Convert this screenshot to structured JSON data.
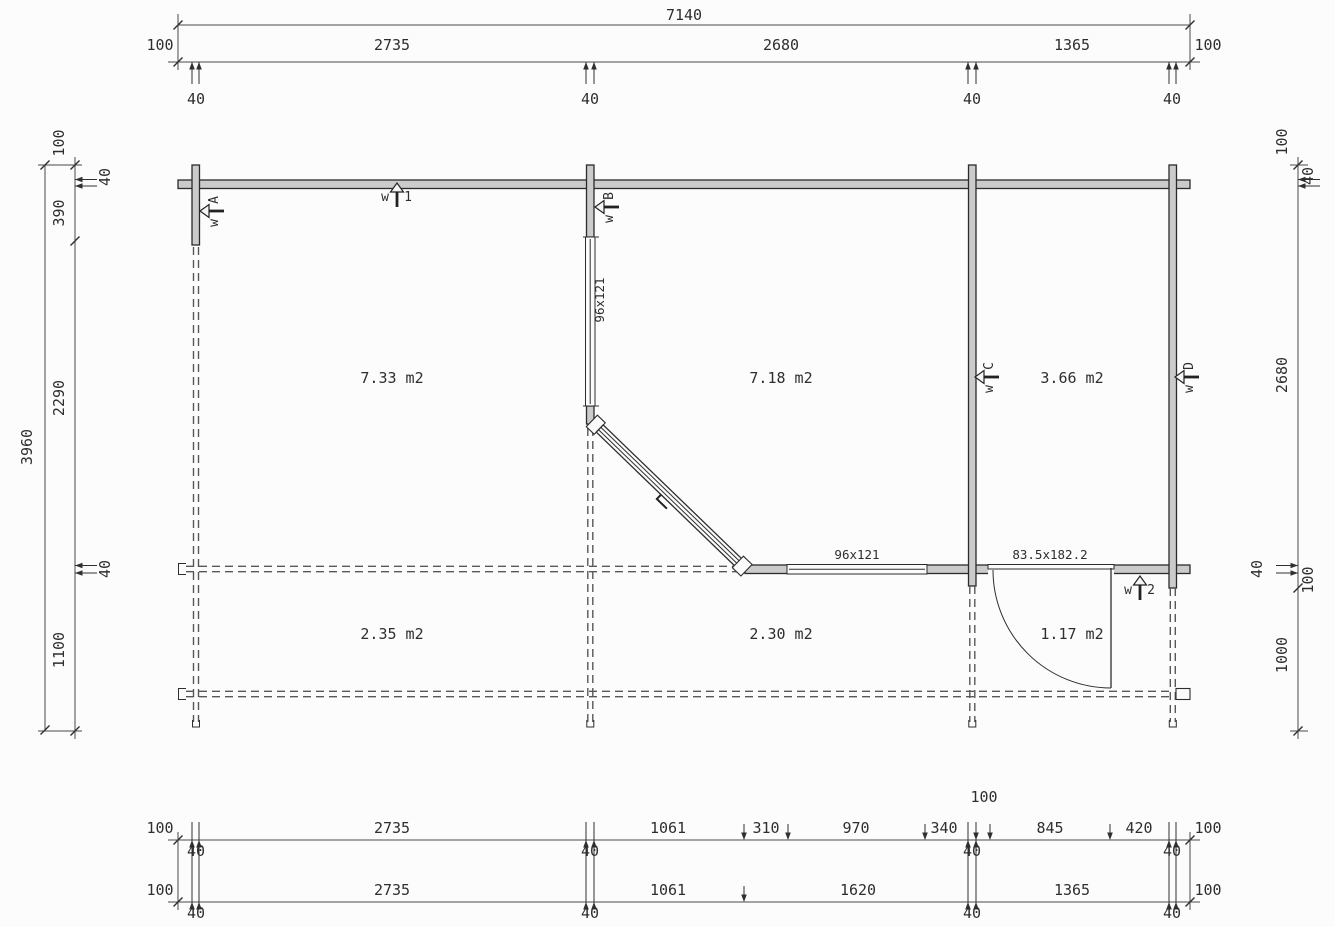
{
  "drawing_title": "log cabin floor plan",
  "dims": {
    "wall40": "40",
    "top": {
      "overall": "7140",
      "c0": "100",
      "c1": "2735",
      "c2": "2680",
      "c3": "1365",
      "c4": "100"
    },
    "left": {
      "overall": "3960",
      "c0": "100",
      "c1": "40",
      "c2": "390",
      "c3": "2290",
      "c4": "40",
      "c5": "1100"
    },
    "right": {
      "c0": "100",
      "c1": "40",
      "c2": "2680",
      "c3": "40",
      "c4": "100",
      "c5": "1000"
    },
    "b1": {
      "c0": "100",
      "c1": "2735",
      "c2": "1061",
      "c3": "310",
      "c4": "970",
      "c5": "340",
      "c6": "845",
      "c7": "420",
      "c8": "100",
      "above": "100"
    },
    "b2": {
      "c0": "100",
      "c1": "2735",
      "c2": "1061",
      "c3": "1620",
      "c4": "1365",
      "c5": "100"
    }
  },
  "rooms": {
    "r1": "7.33 m2",
    "r2": "7.18 m2",
    "r3": "3.66 m2",
    "r4": "2.35 m2",
    "r5": "2.30 m2",
    "r6": "1.17 m2"
  },
  "openings": {
    "window_b": "96x121",
    "window_front": "96x121",
    "door_front": "83.5x182.2"
  },
  "markers": {
    "w1": {
      "prefix": "w",
      "id": "1"
    },
    "w2": {
      "prefix": "w",
      "id": "2"
    },
    "wa": {
      "prefix": "w",
      "id": "A"
    },
    "wb": {
      "prefix": "w",
      "id": "B"
    },
    "wc": {
      "prefix": "w",
      "id": "C"
    },
    "wd": {
      "prefix": "w",
      "id": "D"
    }
  },
  "colors": {
    "wall_fill": "#cbcbcb",
    "line": "#2e2e2e",
    "dashed": "#585858",
    "background": "#fcfcfc"
  }
}
